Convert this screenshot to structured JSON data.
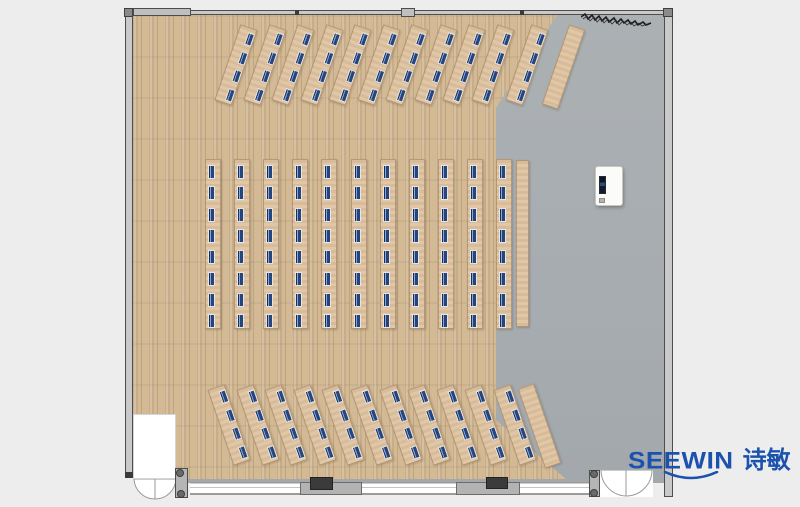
{
  "meta": {
    "title": "Classroom / training room floor plan rendering"
  },
  "brand": {
    "name_latin": "SEEWIN",
    "name_cn": "诗敏",
    "logo_color": "#1b52ae",
    "smile_mark": "arc-under-logo"
  },
  "palette": {
    "background": "#ededed",
    "wood_floor": "#d3b994",
    "stage_floor": "#a9aeb2",
    "desk": "#e0c4a1",
    "seat_marker": "#24457e",
    "wall": "#c9c9c9",
    "wall_block": "#3b3b3b"
  },
  "floorplan": {
    "sections": {
      "top_fan": {
        "desks": 11,
        "seats_per_desk": 4,
        "angle_deg": 19,
        "side_tables": 1
      },
      "middle_rows": {
        "desks": 11,
        "seats_per_desk": 8,
        "angle_deg": 0,
        "side_tables": 1
      },
      "bottom_fan": {
        "desks": 11,
        "seats_per_desk": 4,
        "angle_deg": -19,
        "side_tables": 1
      }
    },
    "features": {
      "podium": "presenter station with screen",
      "doors": [
        "bottom-left double door",
        "bottom-right double door"
      ],
      "glass_wall": "bottom",
      "wall_blocks": 2,
      "curtain_hatch": "top-right wall"
    }
  }
}
